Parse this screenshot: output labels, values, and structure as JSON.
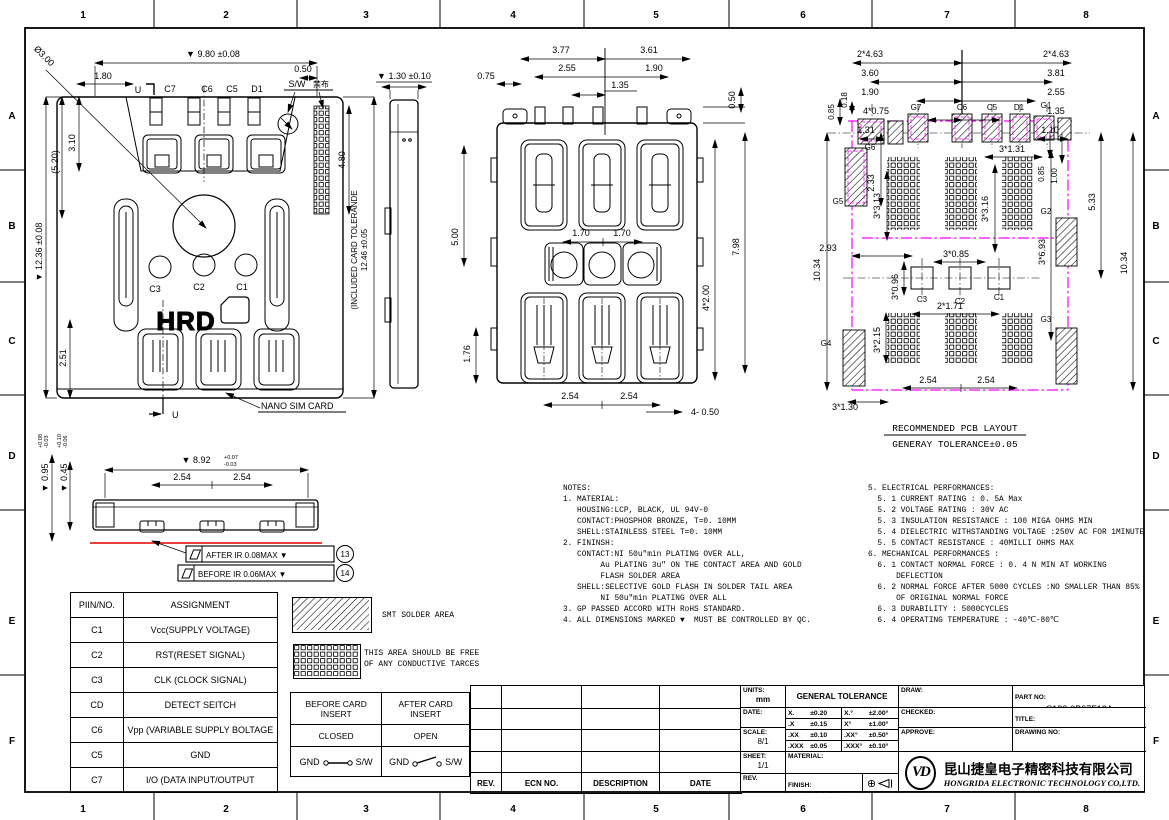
{
  "sheet": {
    "border": {
      "cols": [
        "1",
        "2",
        "3",
        "4",
        "5",
        "6",
        "7",
        "8"
      ],
      "rows": [
        "A",
        "B",
        "C",
        "D",
        "E",
        "F"
      ]
    }
  },
  "top_view": {
    "labels": {
      "u1": "U",
      "c7": "C7",
      "c6": "C6",
      "c5": "C5",
      "d1": "D1",
      "sw": "S/W",
      "jinbu": "禁布",
      "c3": "C3",
      "c2": "C2",
      "c1": "C1",
      "hrd": "HRD",
      "u2": "U",
      "nano": "NANO SIM CARD"
    },
    "dims": {
      "dia": "Ø3.00",
      "w980": "▼ 9.80 ±0.08",
      "d180": "1.80",
      "d050": "0.50",
      "d310": "3.10",
      "d520": "(5.20)",
      "h1236": "▼ 12.36 ±0.08",
      "d251": "2.51",
      "d480": "4.80",
      "tol1": "(INCLUDED CARD TOLERANDE",
      "tol2": "12.46 ±0.05"
    }
  },
  "side_view": {
    "dims": {
      "t130": "▼ 1.30 ±0.10"
    }
  },
  "bottom_view": {
    "dims": {
      "d075": "0.75",
      "d377": "3.77",
      "d361": "3.61",
      "d255": "2.55",
      "d190": "1.90",
      "d135": "1.35",
      "d050": "0.50",
      "d170a": "1.70",
      "d170b": "1.70",
      "d500": "5.00",
      "d176": "1.76",
      "d4200": "4*2.00",
      "d798": "7.98",
      "d254a": "2.54",
      "d254b": "2.54",
      "d4050": "4- 0.50"
    }
  },
  "pcb_layout": {
    "labels": {
      "g1": "G1",
      "g2": "G2",
      "g3": "G3",
      "g4": "G4",
      "g5": "G5",
      "g6": "G6",
      "g7": "G7",
      "c6": "C6",
      "c5": "C5",
      "d1": "D1",
      "c3": "C3",
      "c2": "C2",
      "c1": "C1"
    },
    "dims": {
      "tl1": "2*4.63",
      "tl2": "3.60",
      "tl3": "1.90",
      "tl4": "4*0.75",
      "tl5": "1.31",
      "l085": "0.85",
      "l018": "0.18",
      "tr1": "2*4.63",
      "tr2": "3.81",
      "tr3": "2.55",
      "tr4": "1.35",
      "tr5": "1.10",
      "d233": "2.33",
      "l1034": "10.34",
      "m3131": "3*1.31",
      "m3313": "3*3.13",
      "m3316": "3*3.16",
      "r085": "0.85",
      "r100": "1.00",
      "r533": "5.33",
      "r3693": "3*6.93",
      "r1034": "10.34",
      "b293": "2.93",
      "b3096": "3*0.96",
      "b3085": "3*0.85",
      "b2171": "2*1.71",
      "b3215": "3*2.15",
      "b254a": "2.54",
      "b254b": "2.54",
      "b3130": "3*1.30"
    },
    "caption1": "RECOMMENDED PCB LAYOUT",
    "caption2": "GENERAY TOLERANCE±0.05"
  },
  "section_view": {
    "dims": {
      "d892": "▼ 8.92",
      "d892a": "+0.07",
      "d892b": "-0.03",
      "d095": "▼ 0.95",
      "d095a": "+0.08",
      "d095b": "-0.03",
      "d045": "▼ 0.45",
      "d045a": "+0.10",
      "d045b": "-0.06",
      "d254a": "2.54",
      "d254b": "2.54"
    },
    "callout1": "AFTER IR 0.08MAX ▼",
    "balloon1": "13",
    "callout2": "BEFORE IR 0.06MAX ▼",
    "balloon2": "14"
  },
  "pin_table": {
    "headers": [
      "PIIN/NO.",
      "ASSIGNMENT"
    ],
    "rows": [
      [
        "C1",
        "Vcc(SUPPLY VOLTAGE)"
      ],
      [
        "C2",
        "RST(RESET SIGNAL)"
      ],
      [
        "C3",
        "CLK (CLOCK SIGNAL)"
      ],
      [
        "CD",
        "DETECT SEITCH"
      ],
      [
        "C6",
        "Vpp (VARIABLE SUPPLY BOLTAGE"
      ],
      [
        "C5",
        "GND"
      ],
      [
        "C7",
        "I/O (DATA INPUT/OUTPUT"
      ]
    ]
  },
  "legend": {
    "smt": "SMT SOLDER AREA",
    "free_area": [
      "THIS AREA SHOULD BE FREE",
      "OF ANY CONDUCTIVE TARCES"
    ]
  },
  "switch_table": {
    "col1_header": "BEFORE CARD INSERT",
    "col2_header": "AFTER CARD INSERT",
    "col1_state": "CLOSED",
    "col2_state": "OPEN",
    "gnd": "GND",
    "sw": "S/W"
  },
  "notes_left": {
    "lines": [
      "NOTES:",
      "1. MATERIAL:",
      "   HOUSING:LCP, BLACK, UL 94V-0",
      "   CONTACT:PHOSPHOR BRONZE, T=0. 10MM",
      "   SHELL:STAINLESS STEEL T=0. 10MM",
      "2. FININSH:",
      "   CONTACT:NI 50u″min PLATING OVER ALL,",
      "        Au PLATING 3u″ ON THE CONTACT AREA AND GOLD",
      "        FLASH SOLDER AREA",
      "   SHELL:SELECTIVE GOLD FLASH IN SOLDER TAIL AREA",
      "        NI 50u″min PLATING OVER ALL",
      "3. GP PASSED ACCORD WITH RoHS STANDARD.",
      "4. ALL DIMENSIONS MARKED ▼  MUST BE CONTROLLED BY QC."
    ]
  },
  "notes_right": {
    "lines": [
      "5. ELECTRICAL PERFORMANCES:",
      "  5. 1 CURRENT RATING : 0. 5A Max",
      "  5. 2 VOLTAGE RATING : 30V AC",
      "  5. 3 INSULATION RESISTANCE : 100 MIGA OHMS MIN",
      "  5. 4 DIELECTRIC WITHSTANDING VOLTAGE :250V AC FOR 1MINUTE",
      "  5. 5 CONTACT RESISTANCE : 40MILLI OHMS MAX",
      "6. MECHANICAL PERFORMANCES :",
      "  6. 1 CONTACT NORMAL FORCE : 0. 4 N MIN AT WORKING",
      "      DEFLECTION",
      "  6. 2 NORMAL FORCE AFTER 5000 CYCLES :NO SMALLER THAN 85%",
      "      OF ORIGINAL NORMAL FORCE",
      "  6. 3 DURABILITY : 5000CYCLES",
      "  6. 4 OPERATING TEMPERATURE : -40℃-80℃"
    ]
  },
  "revision_table": {
    "headers": [
      "REV.",
      "ECN NO.",
      "DESCRIPTION",
      "DATE"
    ]
  },
  "title_block": {
    "units_label": "UNITS:",
    "units": "mm",
    "date_label": "DATE:",
    "scale_label": "SCALE:",
    "scale": "8/1",
    "sheet_label": "SHEET:",
    "sheet": "1/1",
    "rev_label": "REV.",
    "material_label": "MATERIAL:",
    "finish_label": "FINISH:",
    "finish": "SEE NOTE",
    "general_tolerance": "GENERAL TOLERANCE",
    "tolerance_rows": [
      [
        "X.",
        "±0.20",
        "X.°",
        "±2.00°"
      ],
      [
        ".X",
        "±0.15",
        "X°",
        "±1.00°"
      ],
      [
        ".XX",
        "±0.10",
        ".XX°",
        "±0.50°"
      ],
      [
        ".XXX",
        "±0.05",
        ".XXX°",
        "±0.10°"
      ]
    ],
    "draw_label": "DRAW:",
    "checked_label": "CHECKED:",
    "approve_label": "APPROVE:",
    "part_no_label": "PART NO:",
    "part_no": "S182-0B07F13A",
    "title_label": "TITLE:",
    "title": "1.3H NANO SIM CARD CONN.",
    "drawing_no_label": "DRAWING NO:",
    "logo": "VD",
    "company_cn": "昆山捷皇电子精密科技有限公司",
    "company_en": "HONGRIDA ELECTRONIC TECHNOLOGY CO,LTD."
  },
  "colors": {
    "magenta": "#ff00ff",
    "red": "#e60000",
    "line": "#000000"
  }
}
